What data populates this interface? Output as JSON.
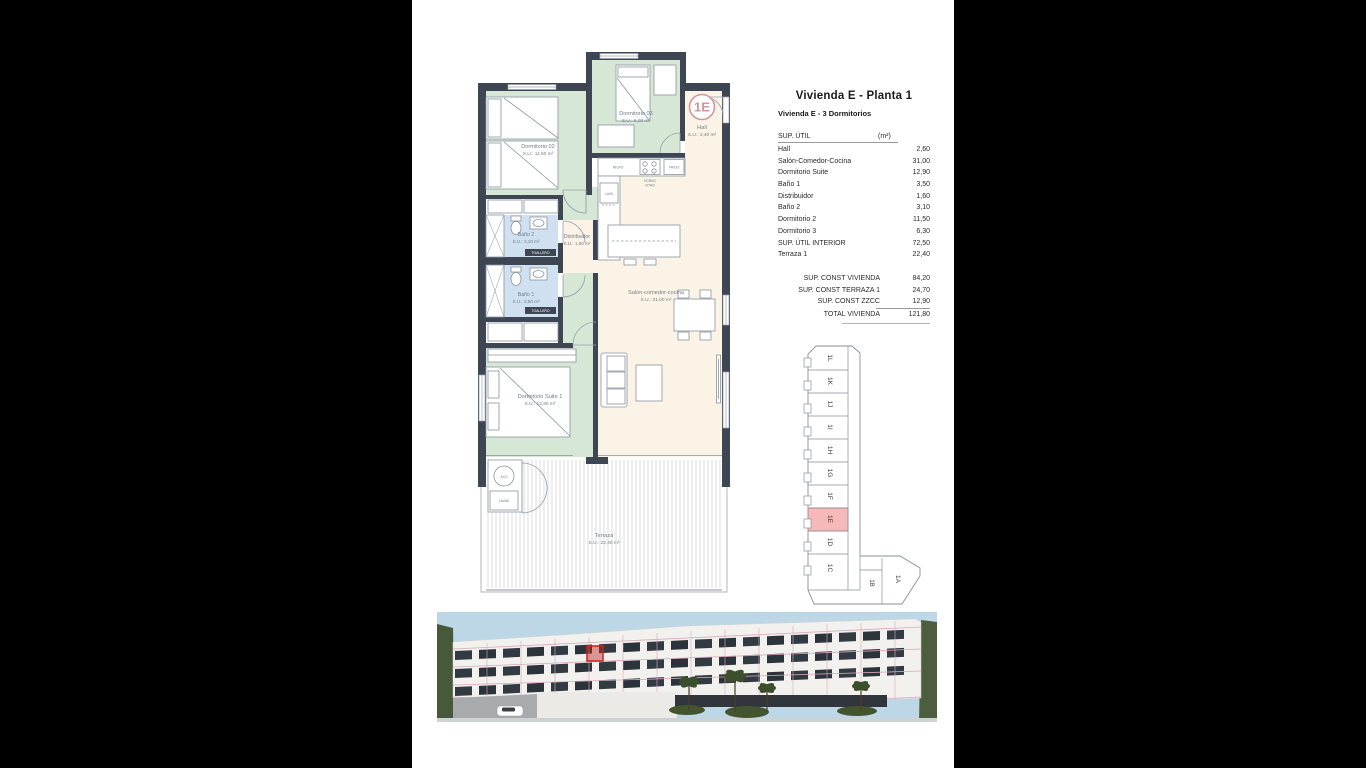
{
  "header": {
    "title": "Vivienda E - Planta 1",
    "subtitle": "Vivienda E - 3 Dormitorios"
  },
  "area_table": {
    "header_label": "SUP. ÚTIL",
    "header_unit": "(m²)",
    "rows": [
      {
        "label": "Hall",
        "value": "2,60"
      },
      {
        "label": "Salón-Comedor-Cocina",
        "value": "31,00"
      },
      {
        "label": "Dormitorio Suite",
        "value": "12,90"
      },
      {
        "label": "Baño 1",
        "value": "3,50"
      },
      {
        "label": "Distribuidor",
        "value": "1,60"
      },
      {
        "label": "Baño 2",
        "value": "3,10"
      },
      {
        "label": "Dormitorio 2",
        "value": "11,50"
      },
      {
        "label": "Dormitorio 3",
        "value": "6,30"
      },
      {
        "label": "SUP. ÚTIL INTERIOR",
        "value": "72,50"
      },
      {
        "label": "Terraza 1",
        "value": "22,40"
      }
    ],
    "totals": [
      {
        "label": "SUP. CONST VIVIENDA",
        "value": "84,20"
      },
      {
        "label": "SUP. CONST TERRAZA 1",
        "value": "24,70"
      },
      {
        "label": "SUP. CONST ZZCC",
        "value": "12,90"
      },
      {
        "label": "TOTAL VIVIENDA",
        "value": "121,80"
      }
    ]
  },
  "floorplan": {
    "unit_badge": "1E",
    "rooms": {
      "dormitorio02": {
        "name": "Dormitorio 02",
        "area": "S.U.: 11,50 m²"
      },
      "dormitorio03": {
        "name": "Dormitorio 03",
        "area": "S.U.: 6,00 m²"
      },
      "hall": {
        "name": "Hall",
        "area": "S.U.: 2,40 m²"
      },
      "bano2": {
        "name": "Baño 2",
        "area": "S.U.: 3,10 m²"
      },
      "distribuidor": {
        "name": "Distribuidor",
        "area": "S.U.: 1,60 m²"
      },
      "bano1": {
        "name": "Baño 1",
        "area": "S.U.: 3,50 m²"
      },
      "salon": {
        "name": "Salón-comedor-cocina",
        "area": "S.U.: 31,00 m²"
      },
      "suite": {
        "name": "Dormitorio Suite 1",
        "area": "S.U.: 12,90 m²"
      },
      "terraza": {
        "name": "Terraza",
        "area": "S.U.: 22,40 m²"
      }
    },
    "appliances": {
      "micro": "MICRO",
      "frigo": "FRIGO",
      "horno_line1": "HORNO",
      "horno_line2": "VITRO",
      "lava": "LAVA",
      "toallero": "TOALLERO",
      "acs": "ACS",
      "lavad": "LAVAD"
    }
  },
  "keyplan": {
    "highlighted_unit": "1E",
    "units": [
      "1L",
      "1K",
      "1J",
      "1I",
      "1H",
      "1G",
      "1F",
      "1E",
      "1D",
      "1C",
      "1B",
      "1A"
    ]
  },
  "colors": {
    "wall": "#3e4654",
    "room_green": "#d6e8d5",
    "room_cream": "#fbf3e6",
    "room_blue": "#cfe0f0",
    "accent_pink": "#d693a0",
    "keyplan_highlight": "#f6b9ba",
    "render_grid_pink": "#d9a8bd",
    "highlight_red": "#c22520"
  }
}
